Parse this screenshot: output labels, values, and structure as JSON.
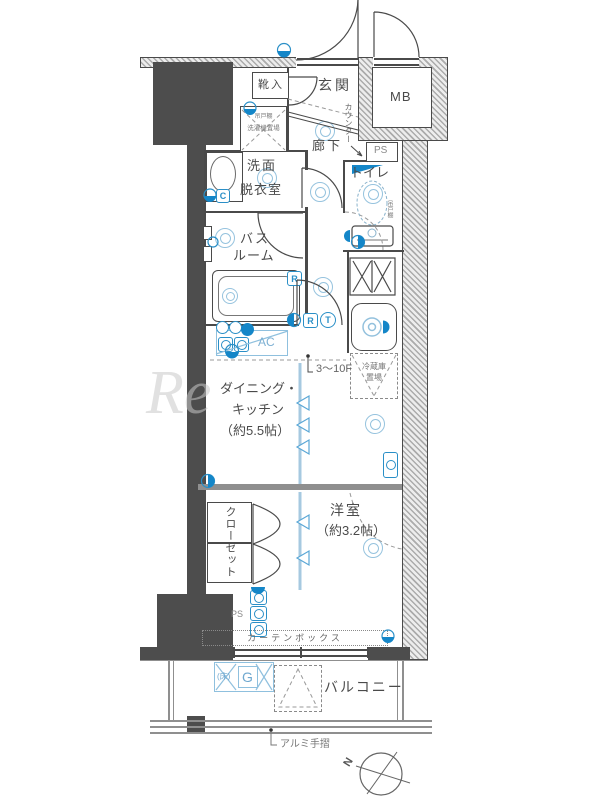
{
  "plan": {
    "watermark": "Re",
    "compass": {
      "north": "N"
    },
    "rooms": {
      "entrance": {
        "label": "玄関"
      },
      "shoe_box": {
        "label": "靴入"
      },
      "meter_box": {
        "label": "MB"
      },
      "corridor": {
        "label": "廊下"
      },
      "toilet": {
        "label": "トイレ"
      },
      "washroom": {
        "line1": "洗面",
        "line2": "脱衣室"
      },
      "bathroom": {
        "line1": "バス",
        "line2": "ルーム"
      },
      "dining_kitchen": {
        "line1": "ダイニング・",
        "line2": "キッチン",
        "line3": "（約5.5帖）"
      },
      "western_room": {
        "line1": "洋室",
        "line2": "（約3.2帖）"
      },
      "closet": {
        "label": "クローゼット"
      },
      "balcony": {
        "label": "バルコニー"
      }
    },
    "annotations": {
      "counter": "カウンター",
      "hanging_shelf_washer": "吊戸棚",
      "washing_machine": "洗濯機置場",
      "hanging_shelf_toilet": "吊戸棚",
      "refrigerator_line1": "冷蔵庫",
      "refrigerator_line2": "置場",
      "air_conditioner": "AC",
      "floors": "3〜10F",
      "ps_top": "PS",
      "ps_bottom": "PS",
      "curtain_box": "カーテンボックス",
      "aluminum_handrail": "アルミ手摺",
      "floor_outlet_mark": "(床)"
    },
    "badges": {
      "c": "C",
      "r_bath": "R",
      "r_dk": "R",
      "t_dk": "T",
      "g": "G"
    },
    "colors": {
      "wall_dark": "#4d4d4d",
      "fixture_blue": "#1486c8",
      "fixture_light_blue": "#8fc0de",
      "line": "#4a4a4a"
    }
  }
}
